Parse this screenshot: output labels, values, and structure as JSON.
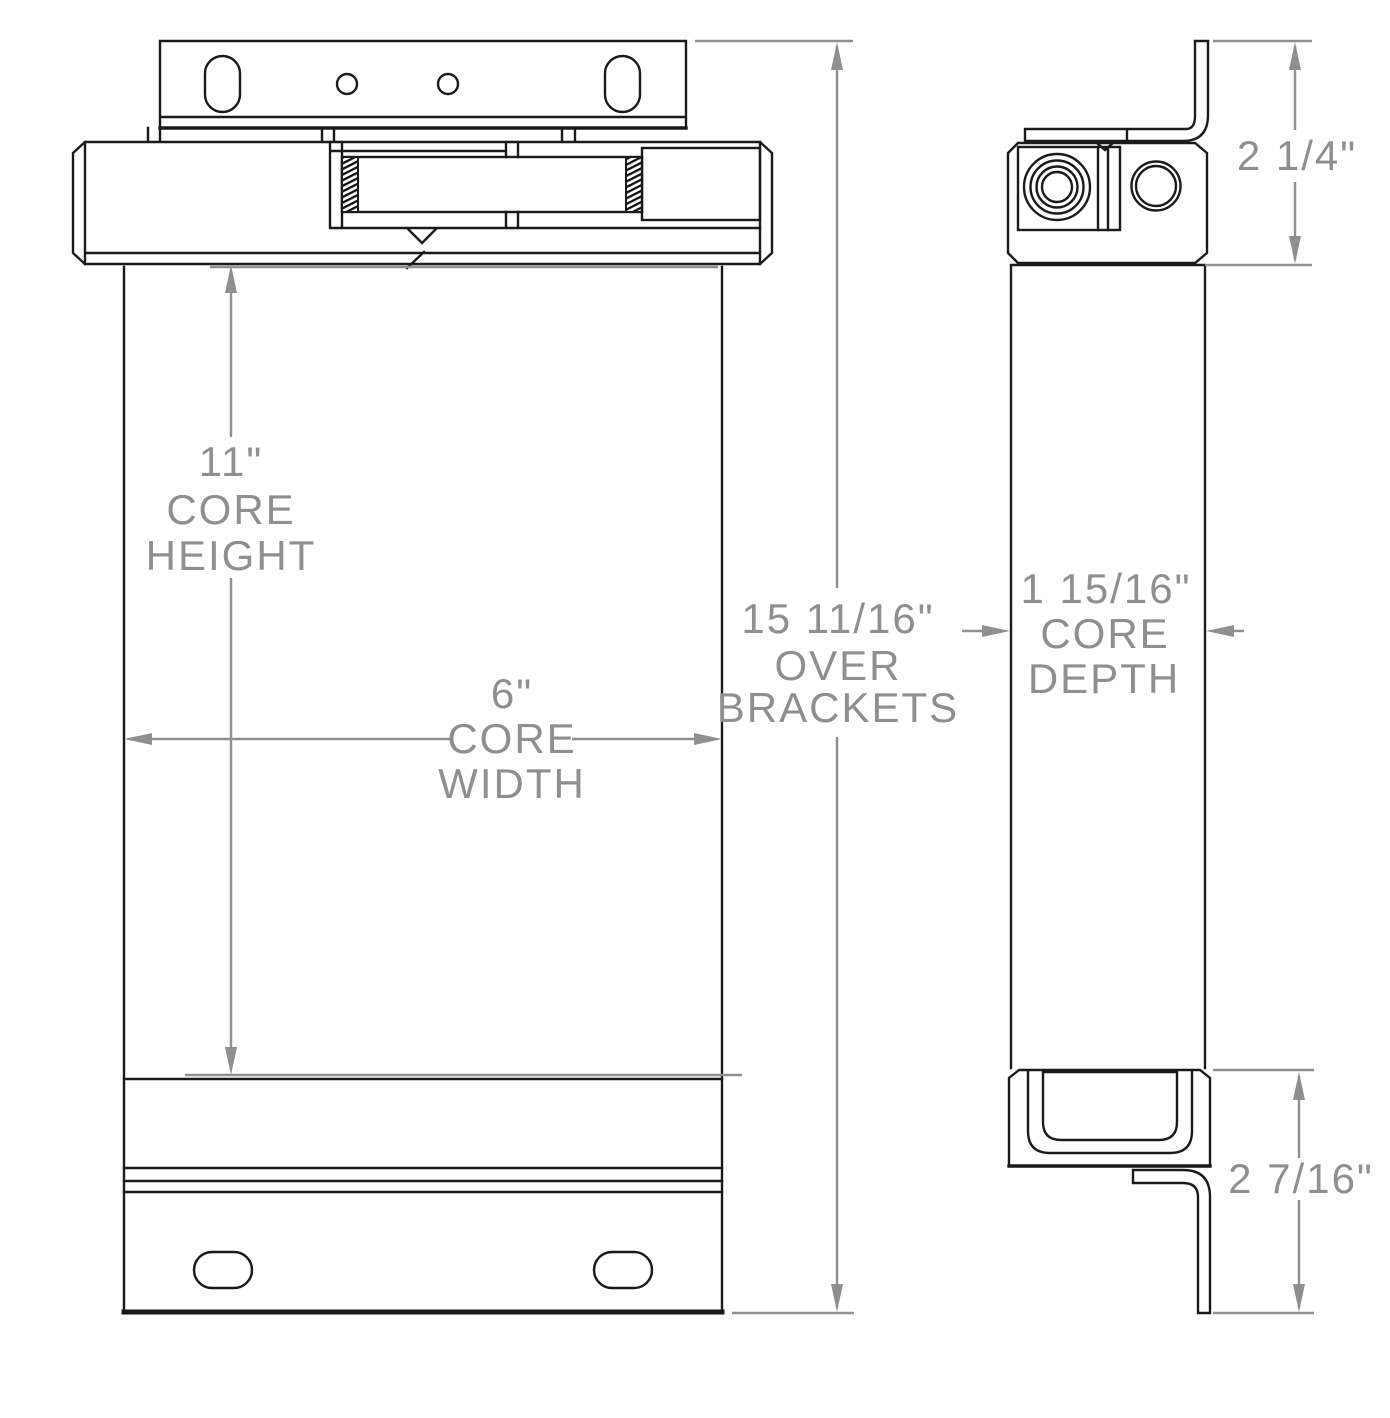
{
  "drawing": {
    "colors": {
      "line": "#1a1a1a",
      "dimension": "#8f8f8f",
      "background": "#ffffff"
    },
    "dimensions": {
      "core_height": {
        "value": "11\"",
        "label_line1": "CORE",
        "label_line2": "HEIGHT"
      },
      "core_width": {
        "value": "6\"",
        "label_line1": "CORE",
        "label_line2": "WIDTH"
      },
      "over_brackets": {
        "value": "15 11/16\"",
        "label_line1": "OVER",
        "label_line2": "BRACKETS"
      },
      "core_depth": {
        "value": "1 15/16\"",
        "label_line1": "CORE",
        "label_line2": "DEPTH"
      },
      "top_bracket_height": {
        "value": "2 1/4\""
      },
      "bottom_bracket_height": {
        "value": "2 7/16\""
      }
    }
  }
}
